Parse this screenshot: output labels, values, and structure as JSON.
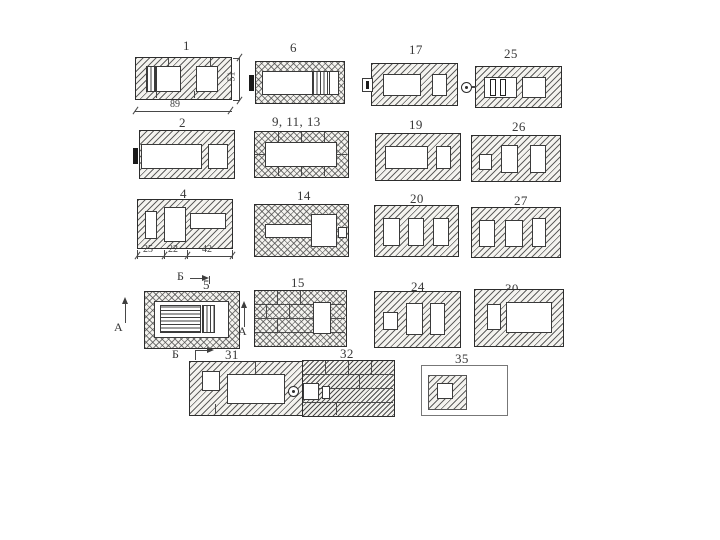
{
  "figures": [
    {
      "label": "1"
    },
    {
      "label": "6"
    },
    {
      "label": "17"
    },
    {
      "label": "25"
    },
    {
      "label": "2"
    },
    {
      "label": "9, 11, 13"
    },
    {
      "label": "19"
    },
    {
      "label": "26"
    },
    {
      "label": "4"
    },
    {
      "label": "14"
    },
    {
      "label": "20"
    },
    {
      "label": "27"
    },
    {
      "label": "5"
    },
    {
      "label": "15"
    },
    {
      "label": "24"
    },
    {
      "label": "30"
    },
    {
      "label": "31"
    },
    {
      "label": "32"
    },
    {
      "label": "35"
    }
  ],
  "dimensions": {
    "overall_width": "89",
    "overall_height": "51",
    "segment_1": "25",
    "segment_2": "22",
    "segment_3": "42"
  },
  "section_marks": {
    "a": "А",
    "b": "Б"
  },
  "colors": {
    "line": "#3a3a3a",
    "hatch_line": "#5a5a5a",
    "masonry_fill": "#f4f3ef",
    "paper": "#ffffff"
  }
}
